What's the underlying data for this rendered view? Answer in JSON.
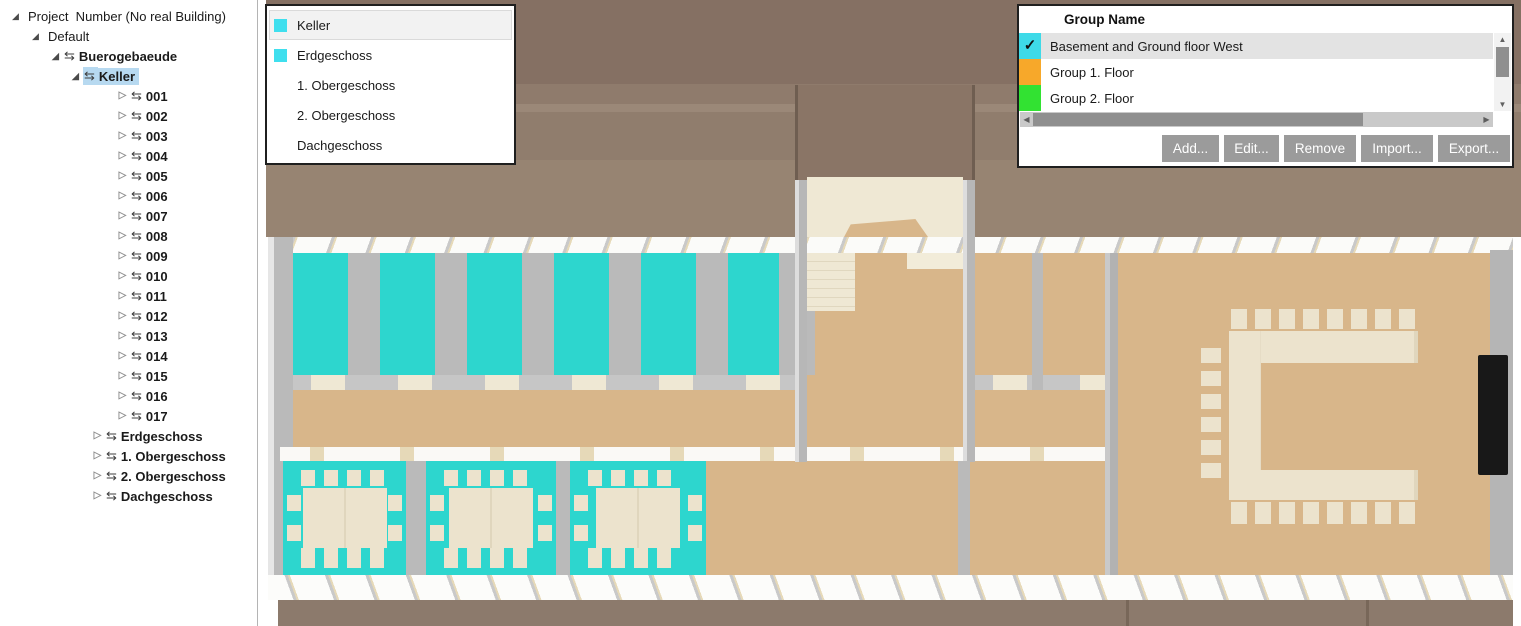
{
  "palette": {
    "roof_dark": "#857063",
    "roof_mid": "#8f7b6c",
    "roof_light": "#9b8878",
    "notch": "#8a7566",
    "ground": "#8c7a6c",
    "tan": "#d8b68a",
    "cyan": "#2dd6ce",
    "wall": "#bababa",
    "cream": "#efe8d4",
    "cream2": "#ece3cd",
    "screen_black": "#181818",
    "select_blue": "#b7d9f0",
    "button_gray": "#9b9b9b"
  },
  "sidebar": {
    "tree": {
      "items": [
        {
          "label": "Project  Number (No real Building)",
          "classes": "lvl0",
          "exp": "◢",
          "icon": ""
        },
        {
          "label": "Default",
          "classes": "lvl1",
          "exp": "◢",
          "icon": ""
        },
        {
          "label": "Buerogebaeude",
          "classes": "lvl2 bold",
          "exp": "◢",
          "icon": "⇆"
        },
        {
          "label": "Keller",
          "classes": "lvl3 bold sel",
          "exp": "◢",
          "icon": "⇆"
        },
        {
          "label": "001",
          "classes": "lvl4 bold",
          "exp": "▷",
          "icon": "⇆"
        },
        {
          "label": "002",
          "classes": "lvl4 bold",
          "exp": "▷",
          "icon": "⇆"
        },
        {
          "label": "003",
          "classes": "lvl4 bold",
          "exp": "▷",
          "icon": "⇆"
        },
        {
          "label": "004",
          "classes": "lvl4 bold",
          "exp": "▷",
          "icon": "⇆"
        },
        {
          "label": "005",
          "classes": "lvl4 bold",
          "exp": "▷",
          "icon": "⇆"
        },
        {
          "label": "006",
          "classes": "lvl4 bold",
          "exp": "▷",
          "icon": "⇆"
        },
        {
          "label": "007",
          "classes": "lvl4 bold",
          "exp": "▷",
          "icon": "⇆"
        },
        {
          "label": "008",
          "classes": "lvl4 bold",
          "exp": "▷",
          "icon": "⇆"
        },
        {
          "label": "009",
          "classes": "lvl4 bold",
          "exp": "▷",
          "icon": "⇆"
        },
        {
          "label": "010",
          "classes": "lvl4 bold",
          "exp": "▷",
          "icon": "⇆"
        },
        {
          "label": "011",
          "classes": "lvl4 bold",
          "exp": "▷",
          "icon": "⇆"
        },
        {
          "label": "012",
          "classes": "lvl4 bold",
          "exp": "▷",
          "icon": "⇆"
        },
        {
          "label": "013",
          "classes": "lvl4 bold",
          "exp": "▷",
          "icon": "⇆"
        },
        {
          "label": "014",
          "classes": "lvl4 bold",
          "exp": "▷",
          "icon": "⇆"
        },
        {
          "label": "015",
          "classes": "lvl4 bold",
          "exp": "▷",
          "icon": "⇆"
        },
        {
          "label": "016",
          "classes": "lvl4 bold",
          "exp": "▷",
          "icon": "⇆"
        },
        {
          "label": "017",
          "classes": "lvl4 bold",
          "exp": "▷",
          "icon": "⇆"
        },
        {
          "label": "Erdgeschoss",
          "classes": "lvl3b bold",
          "exp": "▷",
          "icon": "⇆"
        },
        {
          "label": "1. Obergeschoss",
          "classes": "lvl3b bold",
          "exp": "▷",
          "icon": "⇆"
        },
        {
          "label": "2. Obergeschoss",
          "classes": "lvl3b bold",
          "exp": "▷",
          "icon": "⇆"
        },
        {
          "label": "Dachgeschoss",
          "classes": "lvl3b bold",
          "exp": "▷",
          "icon": "⇆"
        }
      ]
    }
  },
  "floors_panel": {
    "items": [
      {
        "label": "Keller",
        "color": "#3fdfee",
        "classes": "hover"
      },
      {
        "label": "Erdgeschoss",
        "color": "#3fdfee",
        "classes": ""
      },
      {
        "label": "1. Obergeschoss",
        "color": "",
        "classes": ""
      },
      {
        "label": "2. Obergeschoss",
        "color": "",
        "classes": ""
      },
      {
        "label": "Dachgeschoss",
        "color": "",
        "classes": ""
      }
    ]
  },
  "group_panel": {
    "header": "Group Name",
    "groups": [
      {
        "label": "Basement and Ground floor West",
        "color": "#3edae8",
        "classes": "selected",
        "check": "✓"
      },
      {
        "label": "Group 1. Floor",
        "color": "#f7a82a",
        "classes": "",
        "check": ""
      },
      {
        "label": "Group 2. Floor",
        "color": "#32e232",
        "classes": "",
        "check": ""
      }
    ],
    "buttons": [
      {
        "label": "Add...",
        "name": "add-button",
        "w": "57px"
      },
      {
        "label": "Edit...",
        "name": "edit-button",
        "w": "55px"
      },
      {
        "label": "Remove",
        "name": "remove-button",
        "w": "72px"
      },
      {
        "label": "Import...",
        "name": "import-button",
        "w": "72px"
      },
      {
        "label": "Export...",
        "name": "export-button",
        "w": "72px"
      }
    ],
    "scrollbar": {
      "up": "▲",
      "down": "▼",
      "left": "◀",
      "right": "▶"
    }
  }
}
